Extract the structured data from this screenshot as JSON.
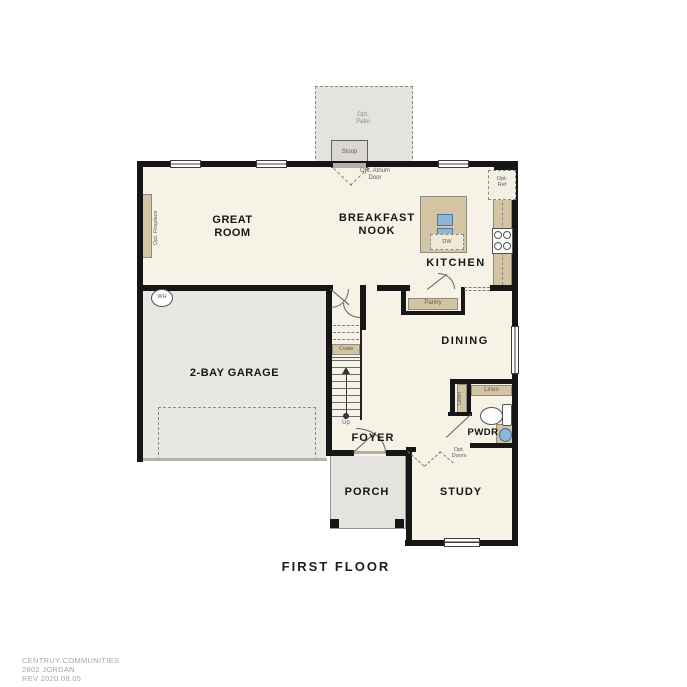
{
  "plan": {
    "title": "FIRST FLOOR",
    "rooms": {
      "great_room": "GREAT ROOM",
      "breakfast_nook": "BREAKFAST NOOK",
      "kitchen": "KITCHEN",
      "dining": "DINING",
      "garage": "2-BAY GARAGE",
      "foyer": "FOYER",
      "porch": "PORCH",
      "study": "STUDY",
      "powder": "PWDR"
    },
    "features": {
      "opt_patio": "Opt. Patio",
      "stoop": "Stoop",
      "opt_atrium_door": "Opt. Atrium Door",
      "opt_ref": "Opt. Ref",
      "dishwasher": "DW",
      "pantry": "Pantry",
      "coats": "Coats",
      "stairs_up": "Up",
      "water_heater": "WH",
      "opt_fireplace": "Opt. Fireplace",
      "linen_closet": "Linen",
      "linen_cabinet": "Linen",
      "opt_doors": "Opt. Doors"
    }
  },
  "footer": {
    "builder": "CENTRUY COMMUNITIES",
    "plan_name": "2802 JORDAN",
    "revision": "REV 2020.08.05"
  },
  "colors": {
    "wall": "#161616",
    "room_fill": "#f6f2e5",
    "garage_fill": "#e9e7e3",
    "patio_fill": "#e5e3df",
    "accent_tan": "#d3c4a4",
    "fixture_blue": "#8fb4d6",
    "label_gray": "#5c5c5c",
    "footer_gray": "#a6a6a6"
  }
}
